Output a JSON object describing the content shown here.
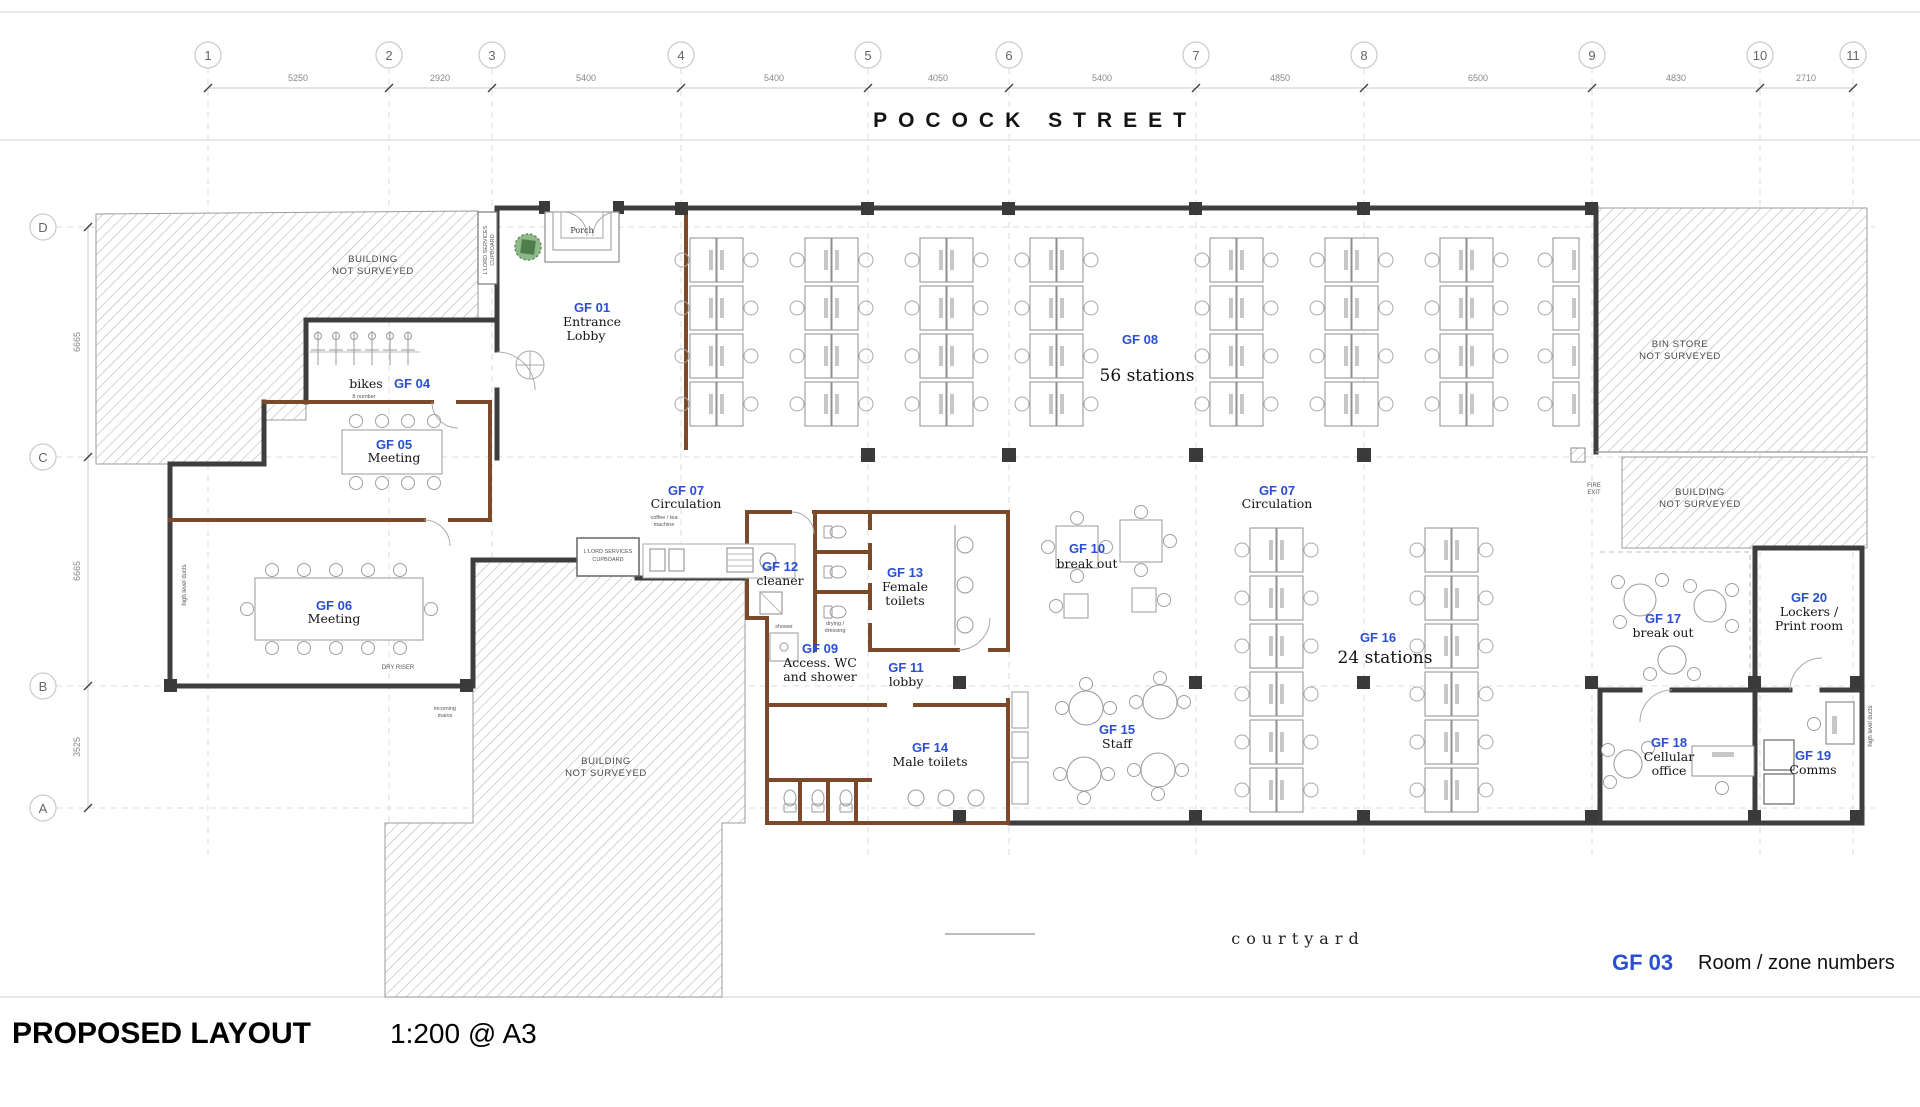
{
  "header": {
    "street": "POCOCK STREET"
  },
  "grid": {
    "cols": [
      {
        "n": "1"
      },
      {
        "n": "2"
      },
      {
        "n": "3"
      },
      {
        "n": "4"
      },
      {
        "n": "5"
      },
      {
        "n": "6"
      },
      {
        "n": "7"
      },
      {
        "n": "8"
      },
      {
        "n": "9"
      },
      {
        "n": "10"
      },
      {
        "n": "11"
      }
    ],
    "col_dims": [
      "5250",
      "2920",
      "5400",
      "5400",
      "4050",
      "5400",
      "4850",
      "6500",
      "4830",
      "2710"
    ],
    "rows": [
      {
        "n": "D"
      },
      {
        "n": "C"
      },
      {
        "n": "B"
      },
      {
        "n": "A"
      }
    ],
    "row_dims": [
      "6665",
      "6665",
      "3525"
    ]
  },
  "rooms": {
    "gf01": {
      "code": "GF 01",
      "l1": "Entrance",
      "l2": "Lobby"
    },
    "gf04": {
      "code": "GF 04",
      "name": "bikes",
      "note": "8 number"
    },
    "gf05": {
      "code": "GF 05",
      "name": "Meeting"
    },
    "gf06": {
      "code": "GF 06",
      "name": "Meeting"
    },
    "gf07": {
      "code": "GF 07",
      "name": "Circulation"
    },
    "gf08": {
      "code": "GF 08",
      "name": "56 stations"
    },
    "gf09": {
      "code": "GF 09",
      "l1": "Access. WC",
      "l2": "and shower"
    },
    "gf10": {
      "code": "GF 10",
      "name": "break out"
    },
    "gf11": {
      "code": "GF 11",
      "name": "lobby"
    },
    "gf12": {
      "code": "GF 12",
      "name": "cleaner"
    },
    "gf13": {
      "code": "GF 13",
      "l1": "Female",
      "l2": "toilets"
    },
    "gf14": {
      "code": "GF 14",
      "name": "Male toilets"
    },
    "gf15": {
      "code": "GF 15",
      "name": "Staff"
    },
    "gf16": {
      "code": "GF 16",
      "name": "24 stations"
    },
    "gf17": {
      "code": "GF 17",
      "name": "break out"
    },
    "gf18": {
      "code": "GF 18",
      "l1": "Cellular",
      "l2": "office"
    },
    "gf19": {
      "code": "GF 19",
      "name": "Comms"
    },
    "gf20": {
      "code": "GF 20",
      "l1": "Lockers /",
      "l2": "Print room"
    }
  },
  "annotations": {
    "not_surveyed_l1": "BUILDING",
    "not_surveyed_l2": "NOT SURVEYED",
    "bin_store_l1": "BIN STORE",
    "bin_store_l2": "NOT SURVEYED",
    "porch": "Porch",
    "tea_point": "tea point",
    "coffee_l1": "coffee / tea",
    "coffee_l2": "machine",
    "cupboard_l1": "L'LORD SERVICES",
    "cupboard_l2": "CUPBOARD",
    "dry_riser": "DRY RISER",
    "incoming_l1": "incoming",
    "incoming_l2": "mains",
    "shower": "shower",
    "drying_l1": "drying /",
    "drying_l2": "dressing",
    "fire_l1": "FIRE",
    "fire_l2": "EXIT",
    "ducts": "high level ducts",
    "courtyard": "courtyard"
  },
  "legend": {
    "code": "GF 03",
    "label": "Room / zone numbers"
  },
  "title_block": {
    "title": "PROPOSED LAYOUT",
    "scale": "1:200 @ A3"
  },
  "colors": {
    "accent_blue": "#2a4fd0",
    "wall_dark": "#3e3e3e",
    "wall_brown": "#7a4a2b",
    "hatch": "#b8afa6"
  }
}
